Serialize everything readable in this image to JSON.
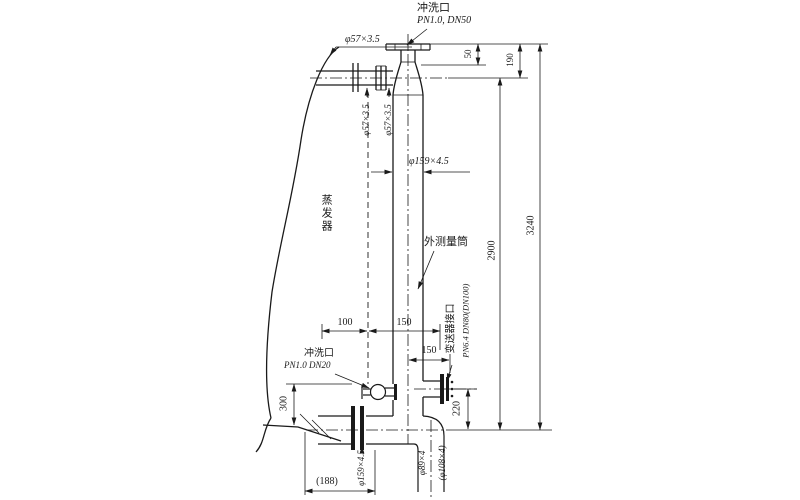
{
  "diagram": {
    "kind": "technical-drawing",
    "labels": {
      "top_flush_name": "冲洗口",
      "top_flush_spec": "PN1.0, DN50",
      "top_pipe_dia": "φ57×3.5",
      "top_pipe_dia_v1": "φ57×3.5",
      "top_pipe_dia_v2": "φ57×3.5",
      "cylinder_dia": "φ159×4.5",
      "cylinder_name": "外测量筒",
      "evaporator_name": "蒸发器",
      "transmitter_name": "变送器接口",
      "transmitter_spec": "PN6.4 DN80(DN100)",
      "bottom_flush_name": "冲洗口",
      "bottom_flush_spec": "PN1.0 DN20",
      "bottom_pipe_dia": "φ159×4.5",
      "drain_dia": "φ89×4",
      "drain_dia_alt": "(φ108×4)"
    },
    "dimensions": {
      "d50": "50",
      "d190": "190",
      "d2900": "2900",
      "d3240": "3240",
      "d100": "100",
      "d150_top": "150",
      "d150_side": "150",
      "d220": "220",
      "d300": "300",
      "d188": "(188)"
    }
  }
}
